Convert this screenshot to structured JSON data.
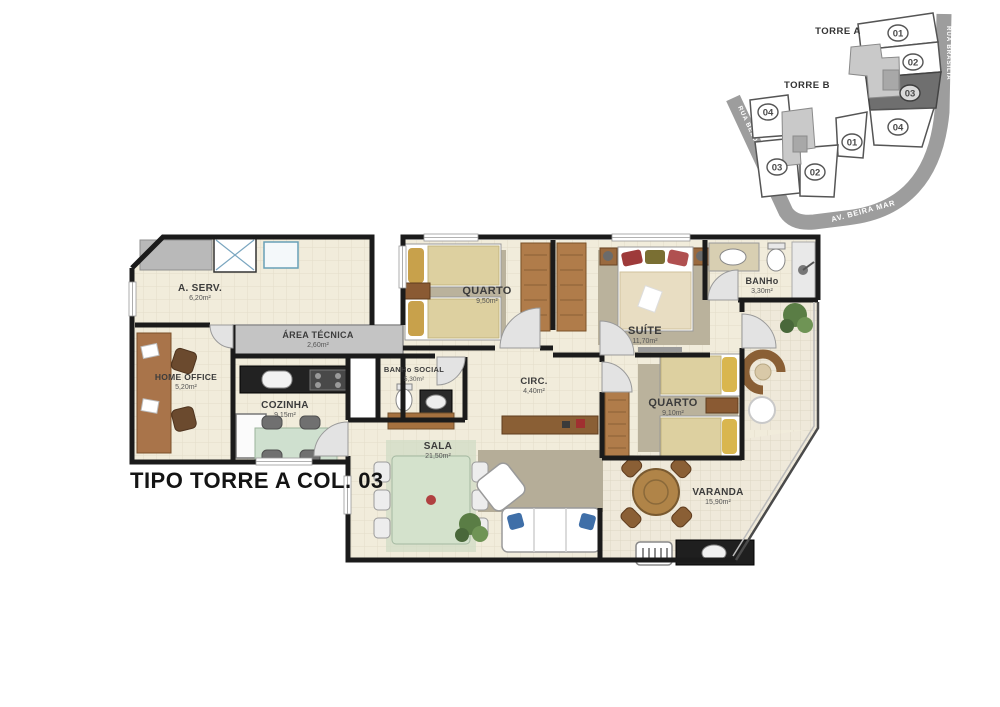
{
  "title": "TIPO TORRE A COL. 03",
  "site_plan": {
    "torre_a": {
      "label": "TORRE A",
      "units": [
        "01",
        "02",
        "03",
        "04"
      ],
      "highlighted_unit": "03"
    },
    "torre_b": {
      "label": "TORRE B",
      "units": [
        "04",
        "01",
        "03",
        "02"
      ]
    },
    "streets": {
      "left": "RUA BELO HORIZONTE",
      "bottom": "AV. BEIRA MAR",
      "right": "RUA BRASÍLIA"
    }
  },
  "rooms": {
    "a_serv": {
      "name": "A. SERV.",
      "area": "6,20m²"
    },
    "area_tecnica": {
      "name": "ÁREA TÉCNICA",
      "area": "2,60m²"
    },
    "home_office": {
      "name": "HOME OFFICE",
      "area": "5,20m²"
    },
    "cozinha": {
      "name": "COZINHA",
      "area": "9,15m²"
    },
    "quarto_1": {
      "name": "QUARTO",
      "area": "9,50m²"
    },
    "suite": {
      "name": "SUÍTE",
      "area": "11,70m²"
    },
    "banho": {
      "name": "BANHo",
      "area": "3,30m²"
    },
    "banho_social": {
      "name": "BANHo SOCIAL",
      "area": "5,30m²"
    },
    "circ": {
      "name": "CIRC.",
      "area": "4,40m²"
    },
    "quarto_2": {
      "name": "QUARTO",
      "area": "9,10m²"
    },
    "sala": {
      "name": "SALA",
      "area": "21,50m²"
    },
    "varanda": {
      "name": "VARANDA",
      "area": "15,90m²"
    }
  },
  "colors": {
    "wall": "#1b1b1b",
    "floor": "#f1ecdb",
    "street": "#9d9d9d",
    "technical_area": "#c4c4c4",
    "highlighted_unit": "#6f6f6f"
  }
}
